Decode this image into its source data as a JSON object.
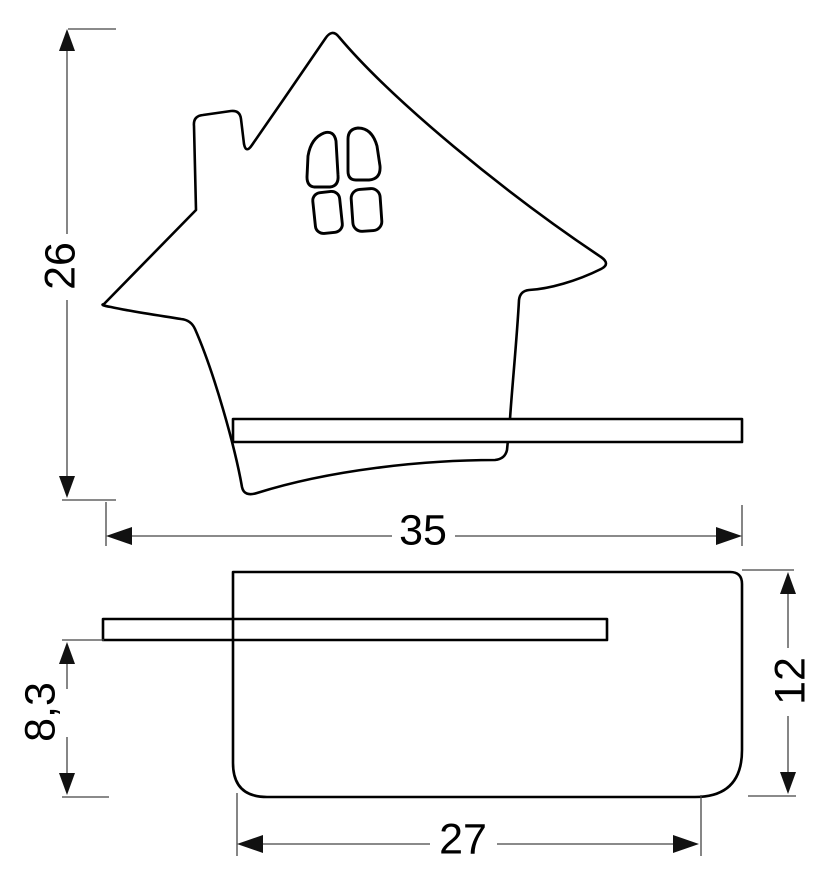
{
  "drawing": {
    "kind": "technical-dimension-drawing",
    "views": {
      "front": "house-shaped wall lamp with shelf, front view",
      "side": "lamp body with protruding shelf, side view"
    },
    "dimensions": {
      "front_height": {
        "value": "26"
      },
      "front_width": {
        "value": "35"
      },
      "shelf_to_bottom": {
        "value": "8,3"
      },
      "side_height": {
        "value": "12"
      },
      "side_bottom_width": {
        "value": "27"
      }
    },
    "colors": {
      "background": "#ffffff",
      "outline": "#000000",
      "dimension": "#444444",
      "text": "#000000"
    }
  }
}
